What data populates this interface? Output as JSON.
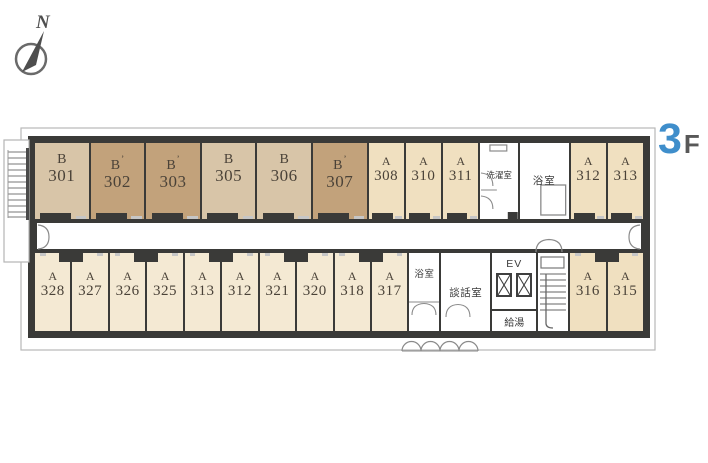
{
  "floor": {
    "number": "3",
    "suffix": "F"
  },
  "compass": {
    "label": "N"
  },
  "colors": {
    "wall": "#3a3a38",
    "accent": "#3f8ecb",
    "bLight": "#d8c5a8",
    "bDark": "#c2a27b",
    "aTop": "#f0e0c0",
    "aBottom": "#f4e9d3"
  },
  "rooms_top": [
    {
      "letter": "B",
      "prime": false,
      "number": "301",
      "shade": "bLight"
    },
    {
      "letter": "B",
      "prime": true,
      "number": "302",
      "shade": "bDark"
    },
    {
      "letter": "B",
      "prime": true,
      "number": "303",
      "shade": "bDark"
    },
    {
      "letter": "B",
      "prime": false,
      "number": "305",
      "shade": "bLight"
    },
    {
      "letter": "B",
      "prime": false,
      "number": "306",
      "shade": "bLight"
    },
    {
      "letter": "B",
      "prime": true,
      "number": "307",
      "shade": "bDark"
    },
    {
      "letter": "A",
      "prime": false,
      "number": "308",
      "shade": "aTop"
    },
    {
      "letter": "A",
      "prime": false,
      "number": "310",
      "shade": "aTop"
    },
    {
      "letter": "A",
      "prime": false,
      "number": "311",
      "shade": "aTop"
    },
    {
      "utility": "laundry",
      "label": "洗濯室"
    },
    {
      "utility": "bath",
      "label": "浴室"
    },
    {
      "letter": "A",
      "prime": false,
      "number": "312",
      "shade": "aTop"
    },
    {
      "letter": "A",
      "prime": false,
      "number": "313",
      "shade": "aTop"
    }
  ],
  "rooms_bottom": [
    {
      "letter": "A",
      "prime": false,
      "number": "328",
      "shade": "aBottom",
      "notch": "right"
    },
    {
      "letter": "A",
      "prime": false,
      "number": "327",
      "shade": "aBottom",
      "notch": "left"
    },
    {
      "letter": "A",
      "prime": false,
      "number": "326",
      "shade": "aBottom",
      "notch": "right"
    },
    {
      "letter": "A",
      "prime": false,
      "number": "325",
      "shade": "aBottom",
      "notch": "left"
    },
    {
      "letter": "A",
      "prime": false,
      "number": "313",
      "shade": "aBottom",
      "notch": "right"
    },
    {
      "letter": "A",
      "prime": false,
      "number": "312",
      "shade": "aBottom",
      "notch": "left"
    },
    {
      "letter": "A",
      "prime": false,
      "number": "321",
      "shade": "aBottom",
      "notch": "right"
    },
    {
      "letter": "A",
      "prime": false,
      "number": "320",
      "shade": "aBottom",
      "notch": "left"
    },
    {
      "letter": "A",
      "prime": false,
      "number": "318",
      "shade": "aBottom",
      "notch": "right"
    },
    {
      "letter": "A",
      "prime": false,
      "number": "317",
      "shade": "aBottom",
      "notch": "left"
    },
    {
      "utility": "bath2",
      "label": "浴室"
    },
    {
      "utility": "lounge",
      "label": "談話室"
    },
    {
      "utility": "ev",
      "label": "EV",
      "sub_label": "給湯"
    },
    {
      "utility": "stairs"
    },
    {
      "letter": "A",
      "prime": false,
      "number": "316",
      "shade": "aTop",
      "notch": "right"
    },
    {
      "letter": "A",
      "prime": false,
      "number": "315",
      "shade": "aTop",
      "notch": "left"
    }
  ]
}
